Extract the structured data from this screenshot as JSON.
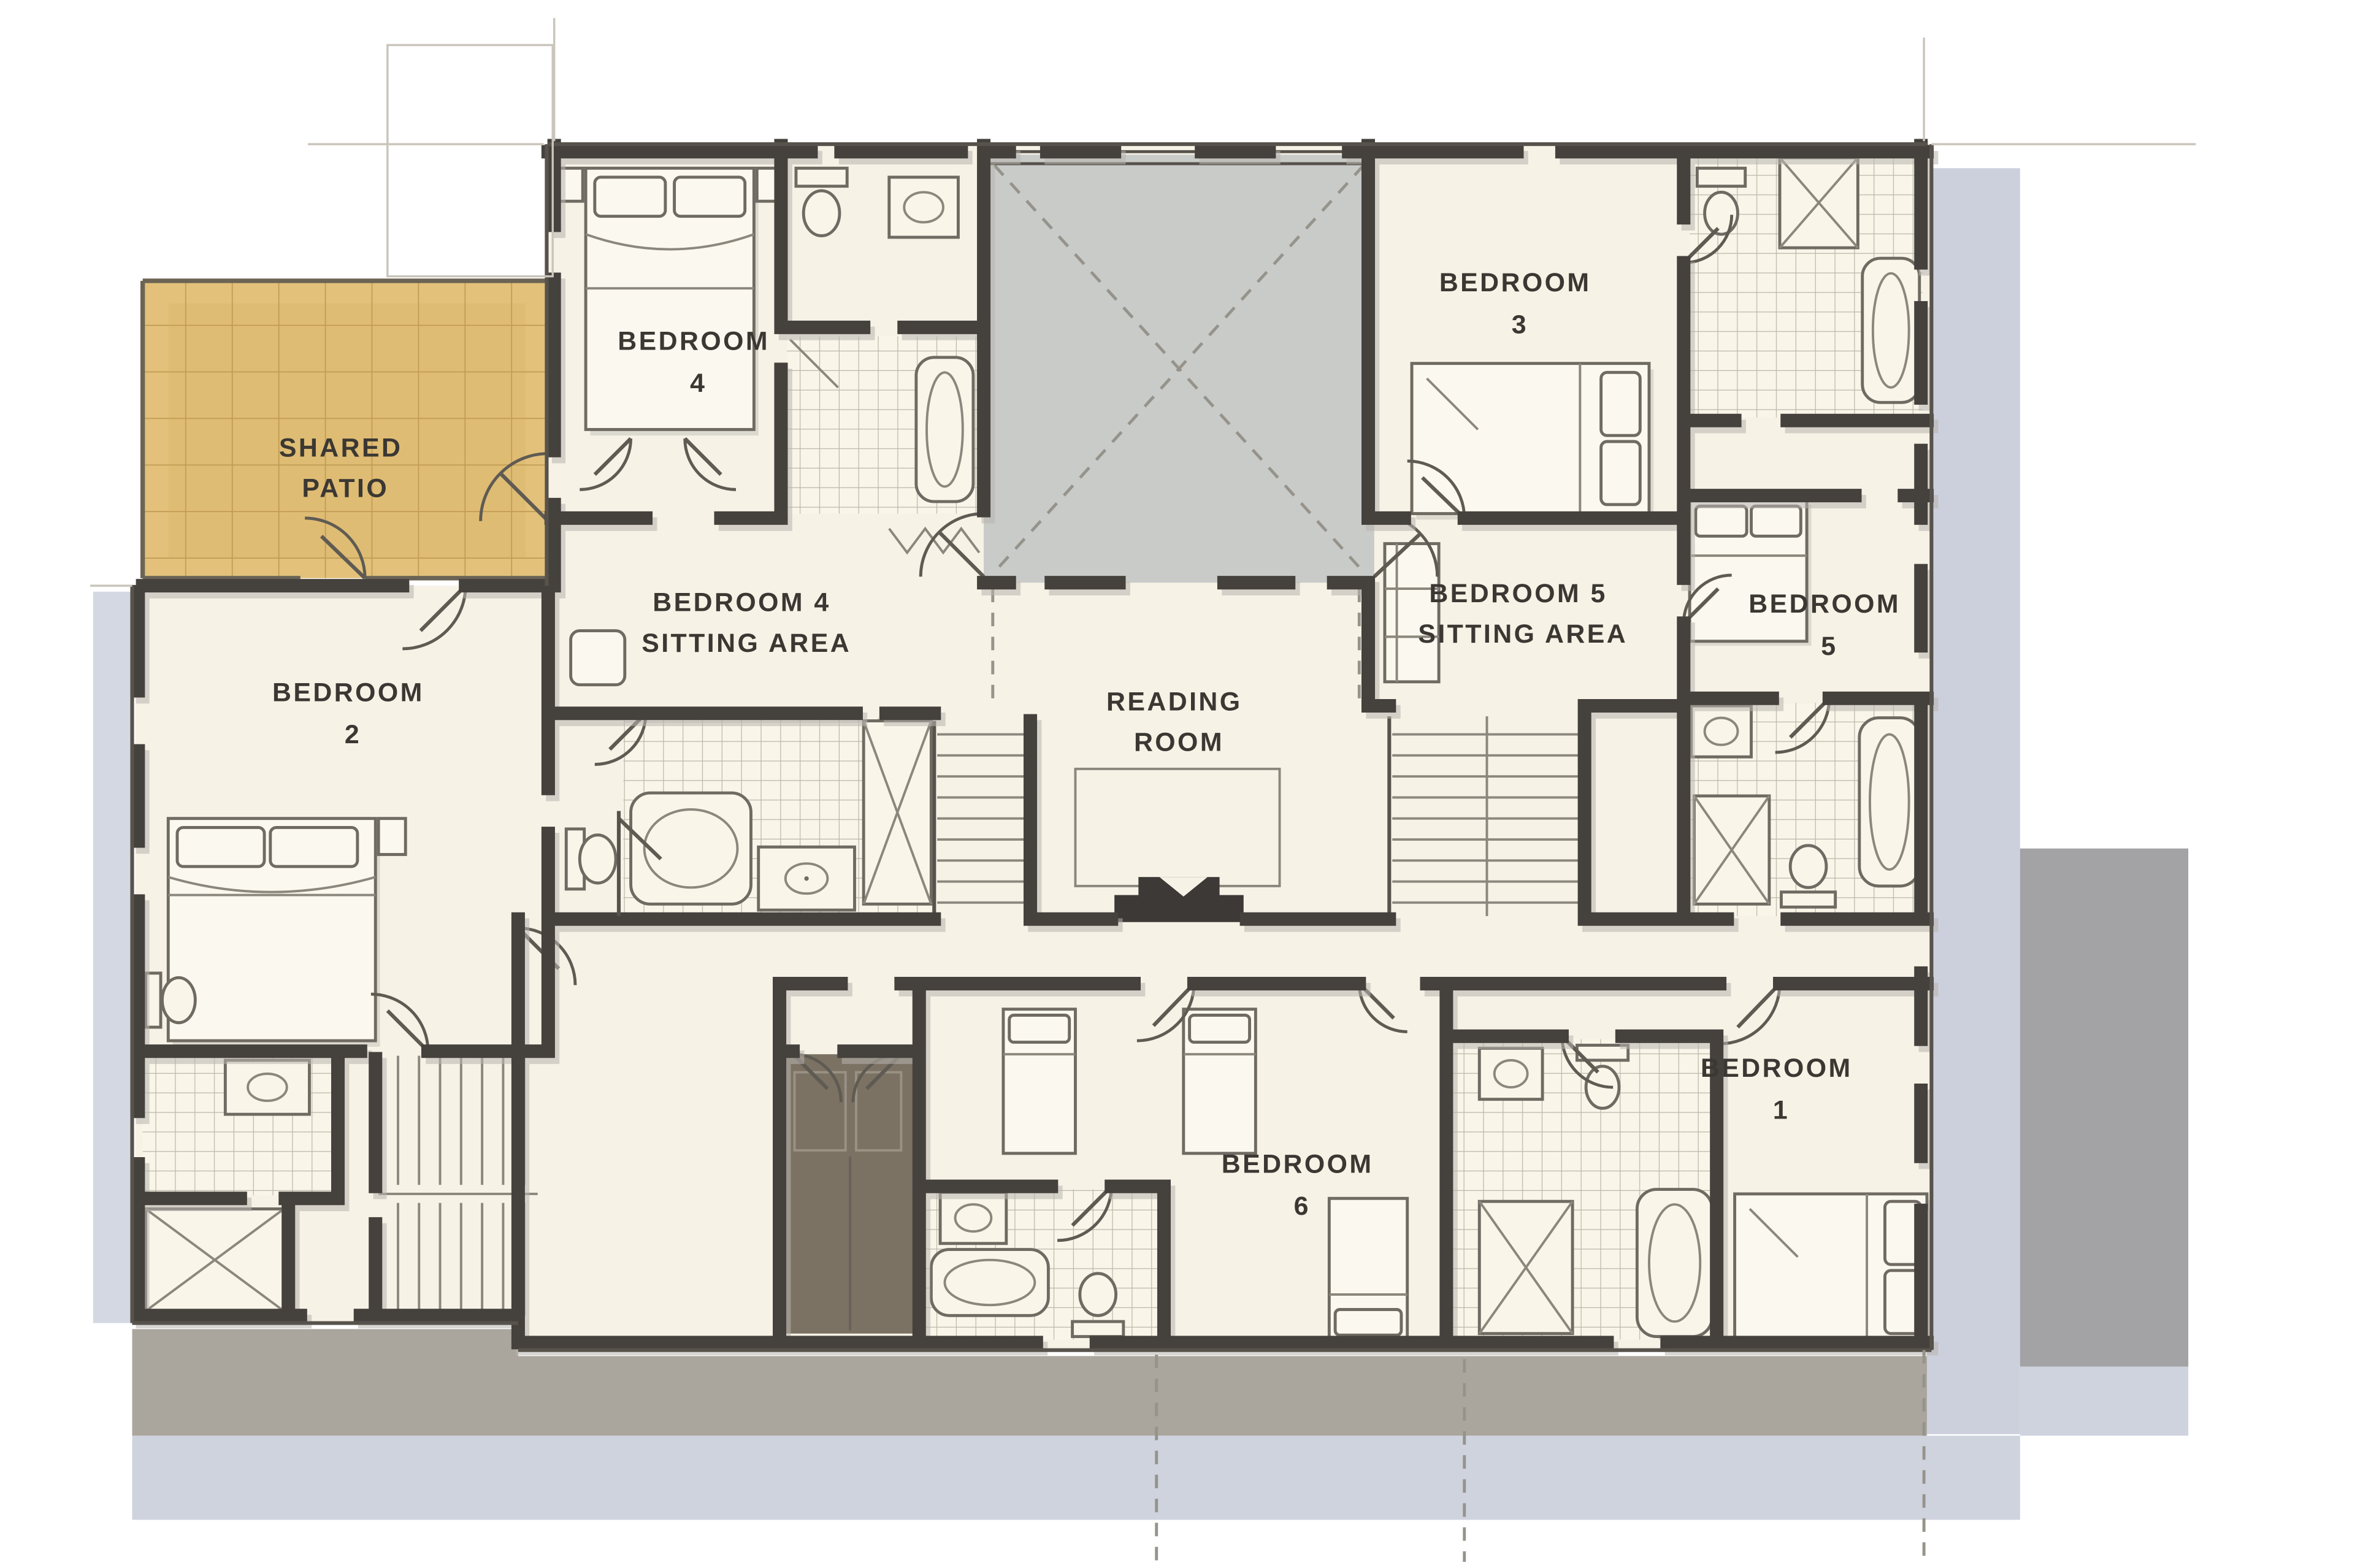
{
  "plan": {
    "type": "architectural-floor-plan",
    "style": "hand-drawn watercolor sketch",
    "floor": "bedroom level"
  },
  "rooms": {
    "shared_patio": {
      "line1": "SHARED",
      "line2": "PATIO"
    },
    "bedroom2": {
      "line1": "BEDROOM",
      "line2": "2"
    },
    "bedroom4": {
      "line1": "BEDROOM",
      "line2": "4"
    },
    "bedroom4_sitting": {
      "line1": "BEDROOM 4",
      "line2": "SITTING AREA"
    },
    "reading_room": {
      "line1": "READING",
      "line2": "ROOM"
    },
    "bedroom3": {
      "line1": "BEDROOM",
      "line2": "3"
    },
    "bedroom5_sitting": {
      "line1": "BEDROOM 5",
      "line2": "SITTING AREA"
    },
    "bedroom5": {
      "line1": "BEDROOM",
      "line2": "5"
    },
    "bedroom6": {
      "line1": "BEDROOM",
      "line2": "6"
    },
    "bedroom1": {
      "line1": "BEDROOM",
      "line2": "1"
    }
  },
  "colors": {
    "wall": "#45413d",
    "floor": "#f6f2e6",
    "patio": "#e3c17b",
    "patioGrid": "#c19b51",
    "courtyard": "#c9cbc9",
    "shadowBlue": "#c6cbd8",
    "shadowGray": "#a3a2a5",
    "terrace": "#aaa69d",
    "closetDark": "#7b7264",
    "ink": "#3b3833",
    "tileBg": "#f9f5e9",
    "tileLine": "#bcb7a8"
  }
}
